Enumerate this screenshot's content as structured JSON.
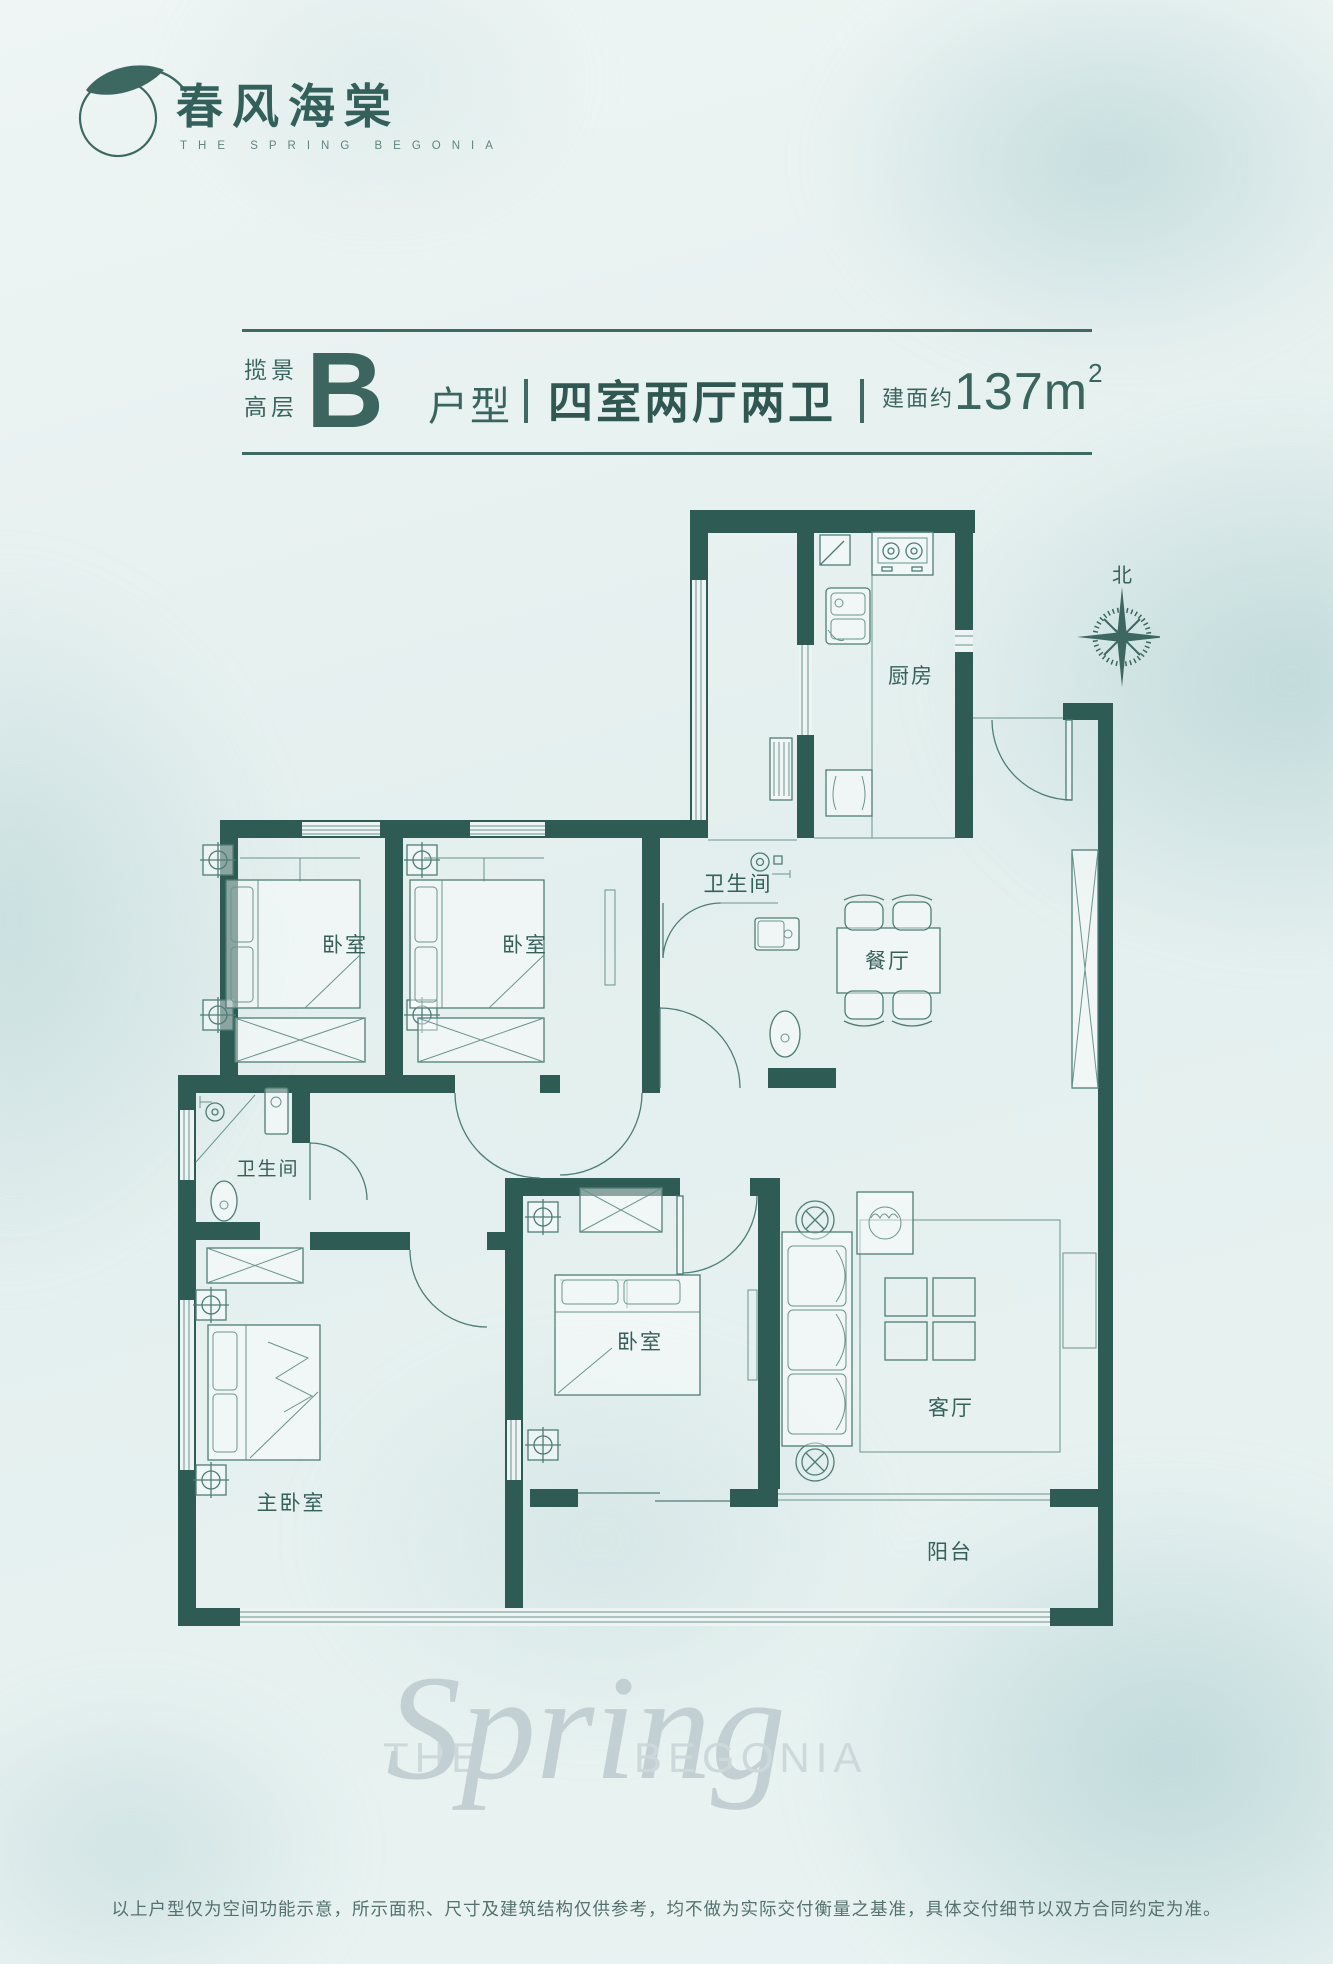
{
  "brand": {
    "name": "春风海棠",
    "name_en": "THE SPRING BEGONIA"
  },
  "title": {
    "prefix_line1": "揽景",
    "prefix_line2": "高层",
    "unit_letter": "B",
    "unit_suffix": "户型",
    "divider": "",
    "layout": "四室两厅两卫",
    "area_label": "建面约",
    "area_value": "137",
    "area_unit": "m",
    "area_sup": "2"
  },
  "compass": {
    "label": "北"
  },
  "rooms": {
    "kitchen": "厨房",
    "bath_upper": "卫生间",
    "dining": "餐厅",
    "bedroom1": "卧室",
    "bedroom2": "卧室",
    "bath_lower": "卫生间",
    "bedroom3": "卧室",
    "living": "客厅",
    "master": "主卧室",
    "balcony": "阳台"
  },
  "watermark": {
    "the": "THE",
    "spring": "Spring",
    "begonia": "BEGONIA"
  },
  "footer": {
    "disclaimer": "以上户型仅为空间功能示意，所示面积、尺寸及建筑结构仅供参考，均不做为实际交付衡量之基准，具体交付细节以双方合同约定为准。"
  },
  "colors": {
    "wall": "#2e5b54",
    "line": "#4e7d76",
    "text": "#356059",
    "accent": "#33605a",
    "background": "#e8f2f1"
  }
}
